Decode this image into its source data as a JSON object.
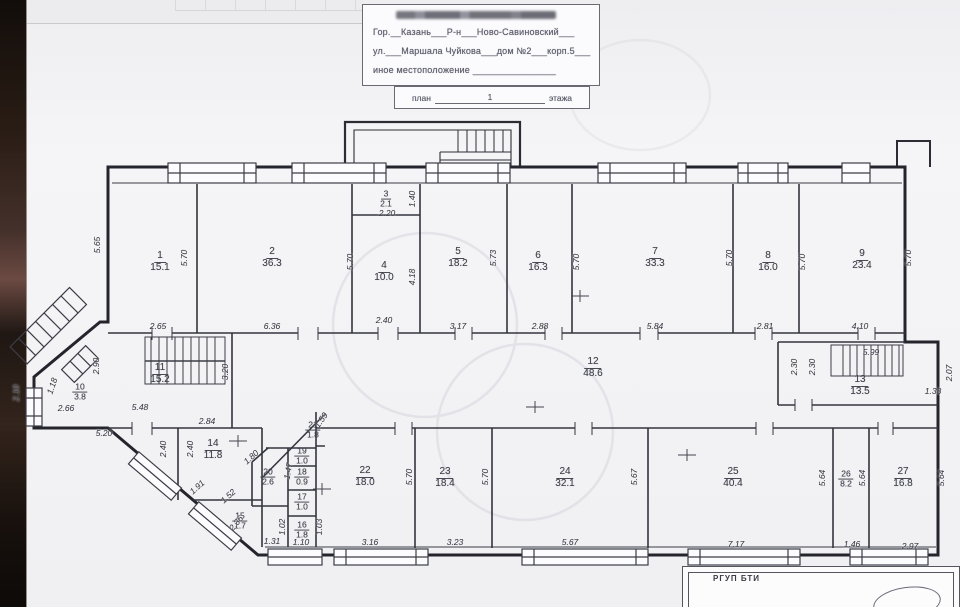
{
  "title_block": {
    "city_line": "Гор.__Казань___Р-н___Ново-Савиновский___",
    "street_line": "ул.___Маршала Чуйкова___дом №2___корп.5___",
    "other_location_line": "иное местоположение ________________",
    "plan_label": "план",
    "floor_number": "1",
    "floor_label": "этажа"
  },
  "stamp": {
    "text": "РГУП БТИ"
  },
  "plan": {
    "drawing_type": "floor-plan",
    "rooms": [
      {
        "n": "1",
        "a": "15.1",
        "x": 160,
        "y": 262
      },
      {
        "n": "2",
        "a": "36.3",
        "x": 272,
        "y": 258
      },
      {
        "n": "3",
        "a": "2.1",
        "x": 386,
        "y": 199,
        "s": 1
      },
      {
        "n": "4",
        "a": "10.0",
        "x": 384,
        "y": 272
      },
      {
        "n": "5",
        "a": "18.2",
        "x": 458,
        "y": 258
      },
      {
        "n": "6",
        "a": "16.3",
        "x": 538,
        "y": 262
      },
      {
        "n": "7",
        "a": "33.3",
        "x": 655,
        "y": 258
      },
      {
        "n": "8",
        "a": "16.0",
        "x": 768,
        "y": 262
      },
      {
        "n": "9",
        "a": "23.4",
        "x": 862,
        "y": 260
      },
      {
        "n": "10",
        "a": "3.8",
        "x": 80,
        "y": 392,
        "s": 1
      },
      {
        "n": "11",
        "a": "15.2",
        "x": 160,
        "y": 374
      },
      {
        "n": "12",
        "a": "48.6",
        "x": 593,
        "y": 368
      },
      {
        "n": "13",
        "a": "13.5",
        "x": 860,
        "y": 386
      },
      {
        "n": "14",
        "a": "11.8",
        "x": 213,
        "y": 450
      },
      {
        "n": "15",
        "a": "1.7",
        "x": 240,
        "y": 521,
        "s": 1
      },
      {
        "n": "16",
        "a": "1.8",
        "x": 302,
        "y": 530,
        "s": 1
      },
      {
        "n": "17",
        "a": "1.0",
        "x": 302,
        "y": 502,
        "s": 1
      },
      {
        "n": "18",
        "a": "0.9",
        "x": 302,
        "y": 477,
        "s": 1
      },
      {
        "n": "19",
        "a": "1.0",
        "x": 302,
        "y": 456,
        "s": 1
      },
      {
        "n": "20",
        "a": "2.6",
        "x": 268,
        "y": 477,
        "s": 1
      },
      {
        "n": "21",
        "a": "1.8",
        "x": 313,
        "y": 430,
        "s": 1
      },
      {
        "n": "22",
        "a": "18.0",
        "x": 365,
        "y": 477
      },
      {
        "n": "23",
        "a": "18.4",
        "x": 445,
        "y": 478
      },
      {
        "n": "24",
        "a": "32.1",
        "x": 565,
        "y": 478
      },
      {
        "n": "25",
        "a": "40.4",
        "x": 733,
        "y": 478
      },
      {
        "n": "26",
        "a": "8.2",
        "x": 846,
        "y": 479,
        "s": 1
      },
      {
        "n": "27",
        "a": "16.8",
        "x": 903,
        "y": 478
      }
    ],
    "dims": [
      {
        "t": "5.65",
        "x": 97,
        "y": 245,
        "r": -90
      },
      {
        "t": "5.70",
        "x": 184,
        "y": 258,
        "r": -90
      },
      {
        "t": "5.70",
        "x": 350,
        "y": 262,
        "r": -90
      },
      {
        "t": "1.40",
        "x": 412,
        "y": 199,
        "r": -90
      },
      {
        "t": "2.20",
        "x": 387,
        "y": 213
      },
      {
        "t": "4.18",
        "x": 412,
        "y": 277,
        "r": -90
      },
      {
        "t": "5.73",
        "x": 493,
        "y": 258,
        "r": -90
      },
      {
        "t": "5.70",
        "x": 576,
        "y": 262,
        "r": -90
      },
      {
        "t": "5.70",
        "x": 729,
        "y": 258,
        "r": -90
      },
      {
        "t": "5.70",
        "x": 802,
        "y": 262,
        "r": -90
      },
      {
        "t": "5.70",
        "x": 908,
        "y": 258,
        "r": -90
      },
      {
        "t": "2.65",
        "x": 158,
        "y": 326
      },
      {
        "t": "6.36",
        "x": 272,
        "y": 326
      },
      {
        "t": "2.40",
        "x": 384,
        "y": 320
      },
      {
        "t": "3.17",
        "x": 458,
        "y": 326
      },
      {
        "t": "2.88",
        "x": 540,
        "y": 326
      },
      {
        "t": "5.84",
        "x": 655,
        "y": 326
      },
      {
        "t": "2.81",
        "x": 765,
        "y": 326
      },
      {
        "t": "4.10",
        "x": 860,
        "y": 326
      },
      {
        "t": "2.10",
        "x": 16,
        "y": 393,
        "r": -90
      },
      {
        "t": "1.18",
        "x": 52,
        "y": 386,
        "r": -72
      },
      {
        "t": "2.66",
        "x": 66,
        "y": 408
      },
      {
        "t": "2.90",
        "x": 96,
        "y": 366,
        "r": -90
      },
      {
        "t": "5.48",
        "x": 140,
        "y": 407
      },
      {
        "t": "3.20",
        "x": 225,
        "y": 372,
        "r": -90
      },
      {
        "t": "2.84",
        "x": 207,
        "y": 421
      },
      {
        "t": "5.20",
        "x": 104,
        "y": 433
      },
      {
        "t": "2.40",
        "x": 163,
        "y": 449,
        "r": -90
      },
      {
        "t": "2.40",
        "x": 190,
        "y": 449,
        "r": -90
      },
      {
        "t": "1.91",
        "x": 197,
        "y": 487,
        "r": -42
      },
      {
        "t": "1.52",
        "x": 228,
        "y": 496,
        "r": -42
      },
      {
        "t": "2.36",
        "x": 236,
        "y": 523,
        "r": -50
      },
      {
        "t": "1.80",
        "x": 251,
        "y": 457,
        "r": -42
      },
      {
        "t": "1.47",
        "x": 288,
        "y": 471,
        "r": -80
      },
      {
        "t": "1.59",
        "x": 321,
        "y": 420,
        "r": -55
      },
      {
        "t": "1.02",
        "x": 282,
        "y": 527,
        "r": -90
      },
      {
        "t": "1.03",
        "x": 319,
        "y": 527,
        "r": -90
      },
      {
        "t": "1.31",
        "x": 272,
        "y": 541
      },
      {
        "t": "1.10",
        "x": 301,
        "y": 542
      },
      {
        "t": "3.16",
        "x": 370,
        "y": 542
      },
      {
        "t": "3.23",
        "x": 455,
        "y": 542
      },
      {
        "t": "5.67",
        "x": 570,
        "y": 542
      },
      {
        "t": "7.17",
        "x": 736,
        "y": 544
      },
      {
        "t": "1.46",
        "x": 852,
        "y": 544
      },
      {
        "t": "2.97",
        "x": 910,
        "y": 546
      },
      {
        "t": "5.70",
        "x": 409,
        "y": 477,
        "r": -90
      },
      {
        "t": "5.70",
        "x": 485,
        "y": 477,
        "r": -90
      },
      {
        "t": "5.67",
        "x": 634,
        "y": 477,
        "r": -90
      },
      {
        "t": "5.64",
        "x": 822,
        "y": 478,
        "r": -90
      },
      {
        "t": "5.64",
        "x": 862,
        "y": 478,
        "r": -90
      },
      {
        "t": "5.64",
        "x": 941,
        "y": 478,
        "r": -90
      },
      {
        "t": "5.99",
        "x": 871,
        "y": 352
      },
      {
        "t": "2.30",
        "x": 794,
        "y": 367,
        "r": -90
      },
      {
        "t": "2.30",
        "x": 812,
        "y": 367,
        "r": -90
      },
      {
        "t": "2.07",
        "x": 949,
        "y": 373,
        "r": -90
      },
      {
        "t": "1.38",
        "x": 933,
        "y": 391
      }
    ]
  }
}
